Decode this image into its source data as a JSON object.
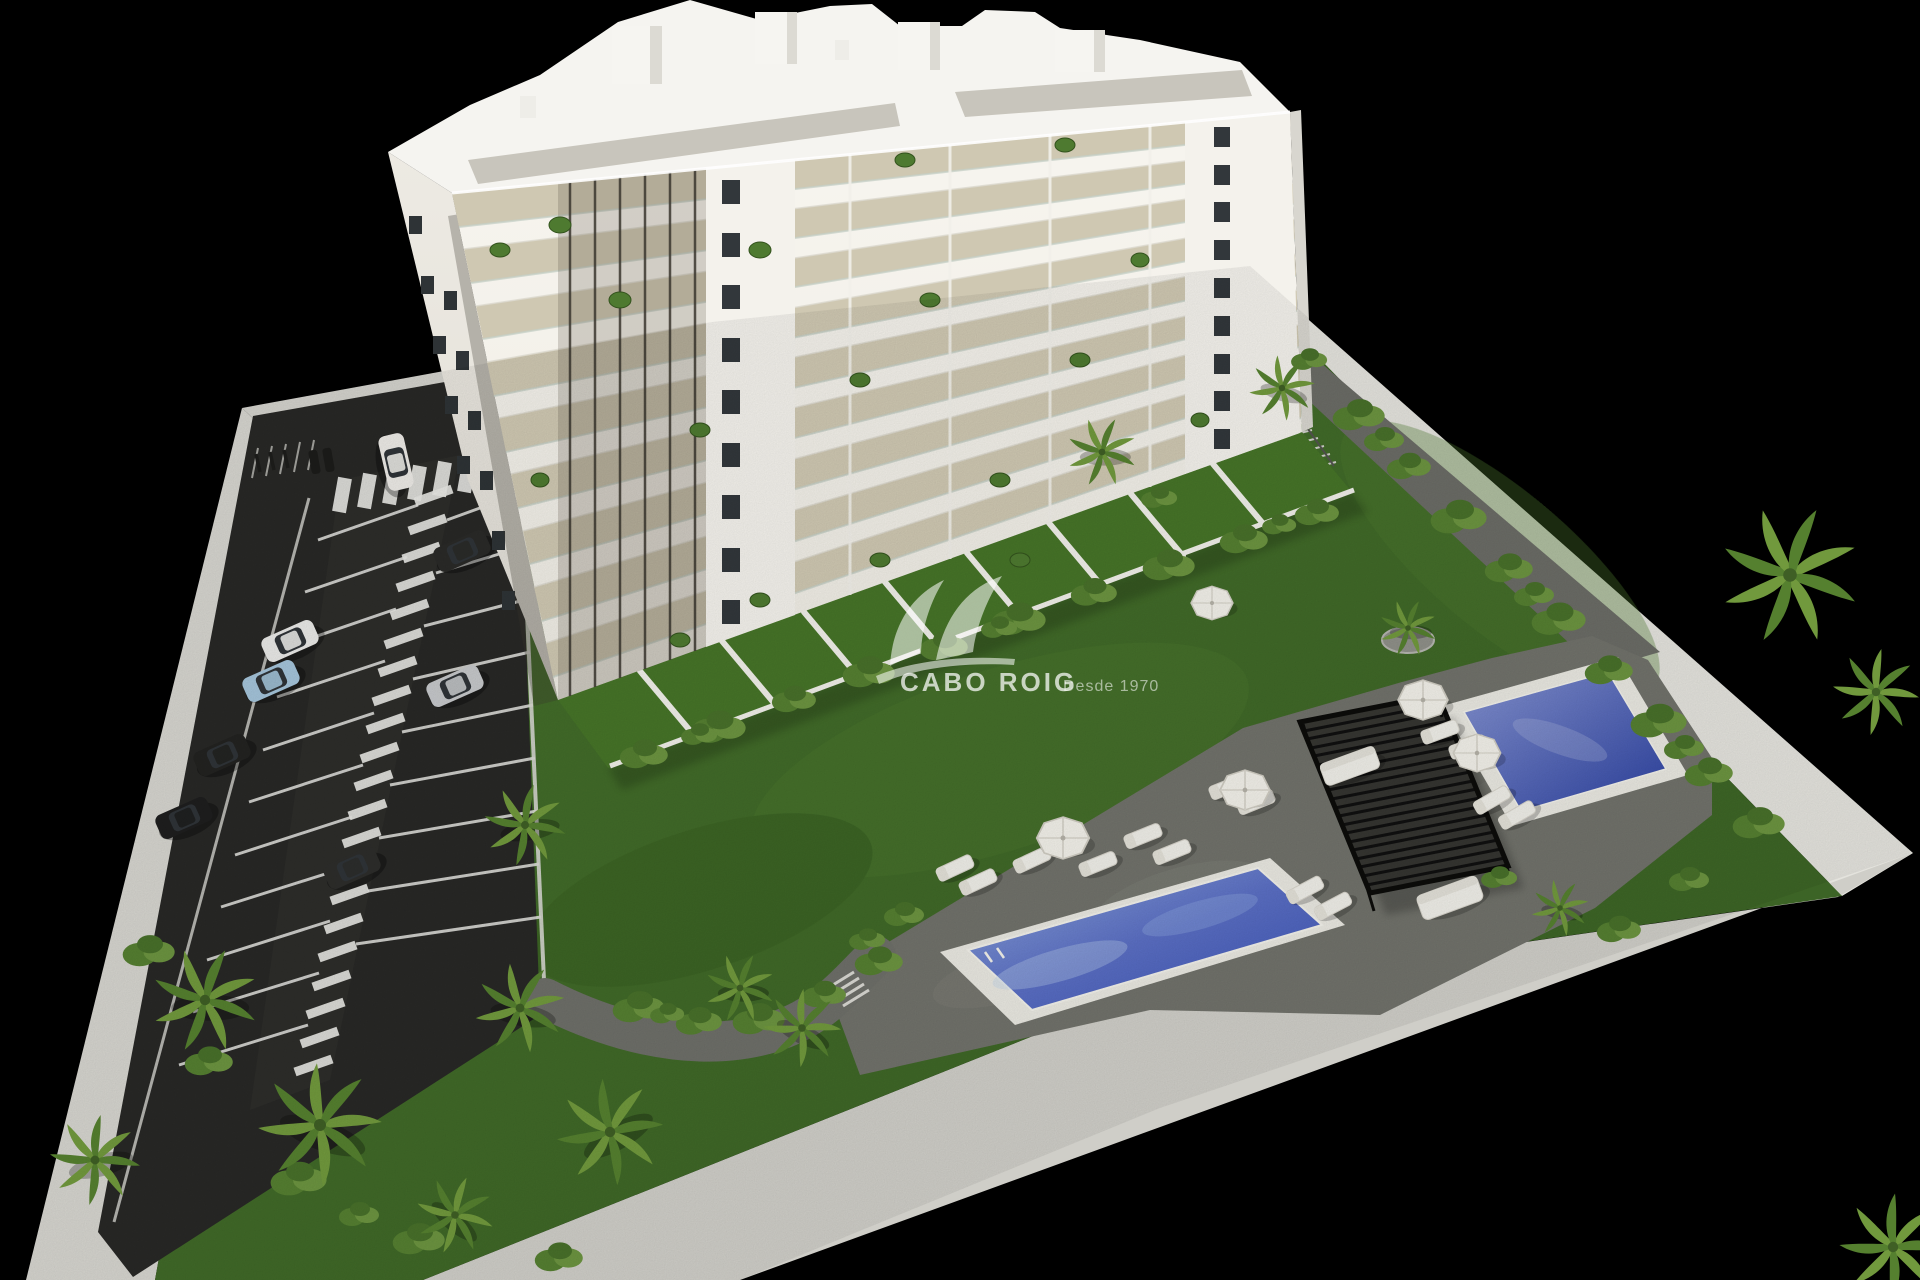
{
  "meta": {
    "kind": "3d-architectural-site-render",
    "background_color": "#000000",
    "view": "aerial-isometric"
  },
  "watermark": {
    "brand": "CABO ROIG",
    "tagline": "Desde 1970",
    "logo": "double-swoosh-monogram",
    "color": "#ffffff"
  },
  "scene": {
    "building": {
      "type": "apartment-block",
      "balcony_floors": 9,
      "facade_color": "#f4f2ec",
      "side_facade_color": "#e9e6df",
      "balcony_floor_color": "#cfc8b2",
      "roof_gravel_color": "#c8c5bc",
      "window_color": "#32373b"
    },
    "pools": [
      {
        "name": "main-lap-pool",
        "deck_color": "#e9e8e1",
        "water_top": "#8fa8dc",
        "water_deep": "#3b53b5"
      },
      {
        "name": "secondary-pool",
        "deck_color": "#e9e8e1",
        "water_top": "#8694d2",
        "water_deep": "#2c41a0"
      }
    ],
    "pergola": {
      "style": "slatted",
      "color": "#2e2e2a"
    },
    "furniture": {
      "sun_loungers": 14,
      "parasols": 5,
      "outdoor_sofas": 2
    },
    "parking": {
      "asphalt_color": "#282826",
      "marking_color": "#e8e8e4",
      "cars": [
        {
          "color": "white",
          "state": "driving"
        },
        {
          "color": "dark-gray"
        },
        {
          "color": "white"
        },
        {
          "color": "light-blue"
        },
        {
          "color": "silver"
        },
        {
          "color": "black"
        },
        {
          "color": "black"
        },
        {
          "color": "black"
        },
        {
          "color": "white"
        }
      ],
      "features": [
        "central-pedestrian-walkway",
        "zebra-crossing",
        "bicycle-racks",
        "motorbike-bays"
      ]
    },
    "landscape": {
      "lawn_color": "#41682a",
      "terrace_color": "#71726b",
      "path_color": "#6e6f69",
      "perimeter_wall_color": "#d6d5cf",
      "vegetation": [
        "palm-trees",
        "shrubs",
        "flowering-bushes",
        "balcony-plants"
      ]
    }
  }
}
